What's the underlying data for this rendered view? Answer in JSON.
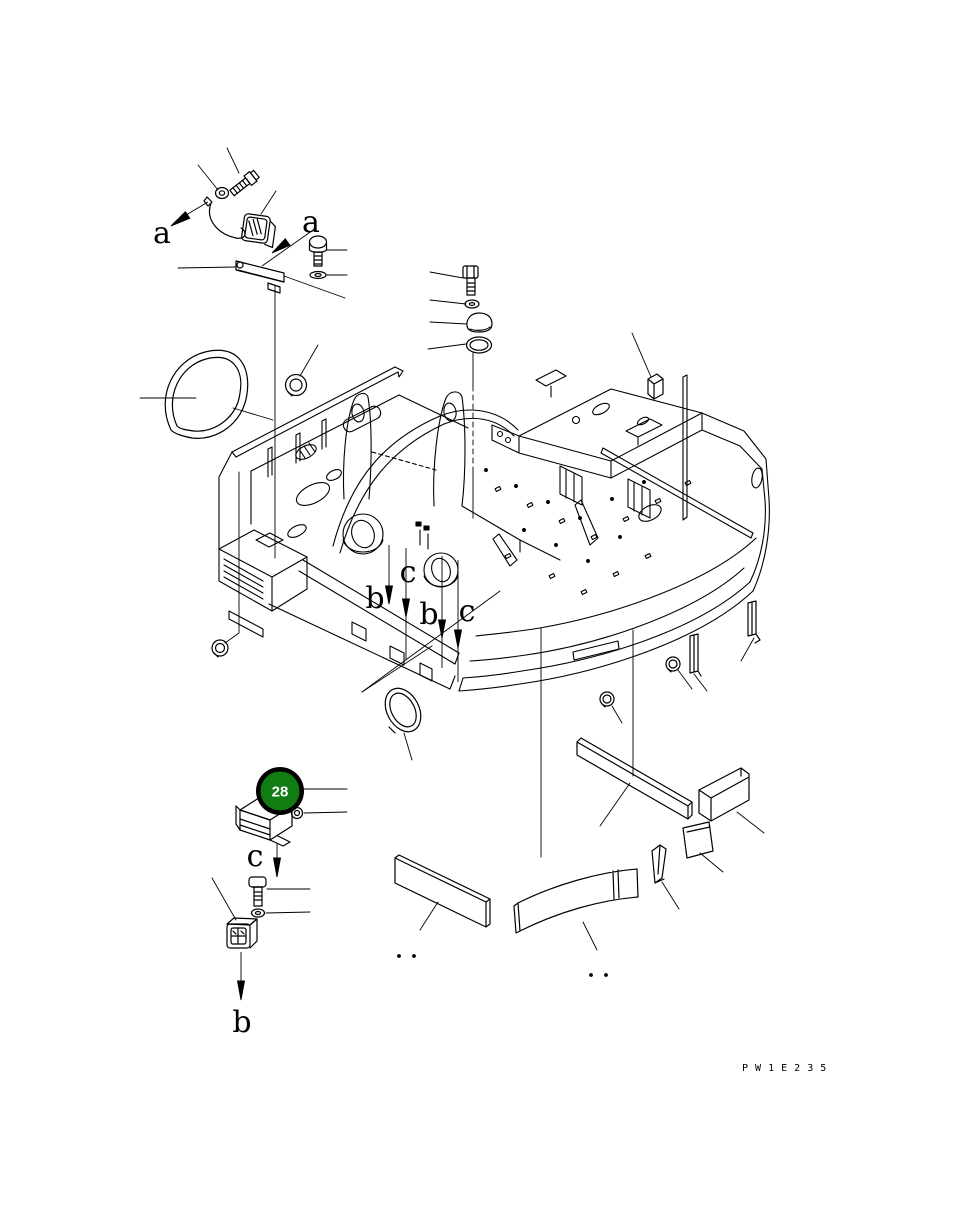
{
  "page": {
    "background": "#ffffff",
    "line_color": "#000000"
  },
  "drawing": {
    "code": "PW1E235",
    "code_display": "P W 1 E 2 3 5",
    "item_badge": {
      "number": "28",
      "fill": "#117c11",
      "ring_color": "#000000",
      "text_color": "#ffffff"
    },
    "callouts": [
      {
        "id": "a-1",
        "label": "a"
      },
      {
        "id": "a-2",
        "label": "a"
      },
      {
        "id": "c-1",
        "label": "c"
      },
      {
        "id": "b-1",
        "label": "b"
      },
      {
        "id": "b-2",
        "label": "b"
      },
      {
        "id": "c-2",
        "label": "c"
      },
      {
        "id": "c-3",
        "label": "c"
      },
      {
        "id": "b-3",
        "label": "b"
      }
    ]
  }
}
